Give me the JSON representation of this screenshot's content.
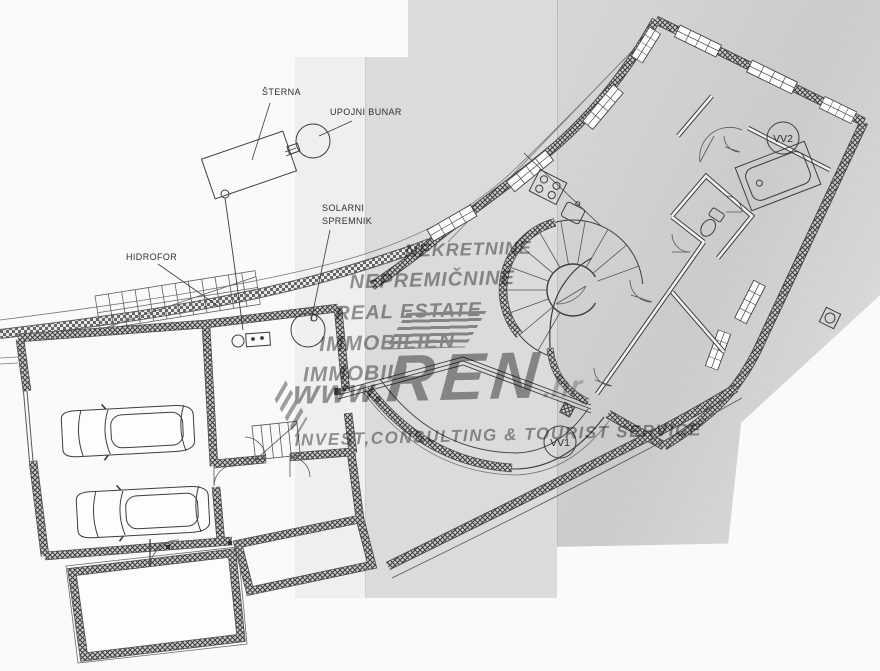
{
  "labels": {
    "sterna": "ŠTERNA",
    "upojni_bunar": "UPOJNI BUNAR",
    "solarni_line1": "SOLARNI",
    "solarni_line2": "SPREMNIK",
    "hidrofor": "HIDROFOR",
    "vv1": "VV1",
    "vv2": "VV2"
  },
  "watermark": {
    "languages": [
      "NEKRETNINE",
      "NEPREMIČNINE",
      "REAL ESTATE",
      "IMMOBILIEN",
      "IMMOBILI"
    ],
    "url_prefix": "www.",
    "url_name": "REN",
    "url_suffix": ".hr",
    "tagline": "INVEST,CONSULTING & TOURIST SERVICE"
  },
  "colors": {
    "paper_left": "#fafaf8",
    "paper_band": "#dcdbd9",
    "paper_right": "#cfcecc",
    "ink": "#3d3d3d",
    "watermark_gray": "#9a9a9a"
  }
}
